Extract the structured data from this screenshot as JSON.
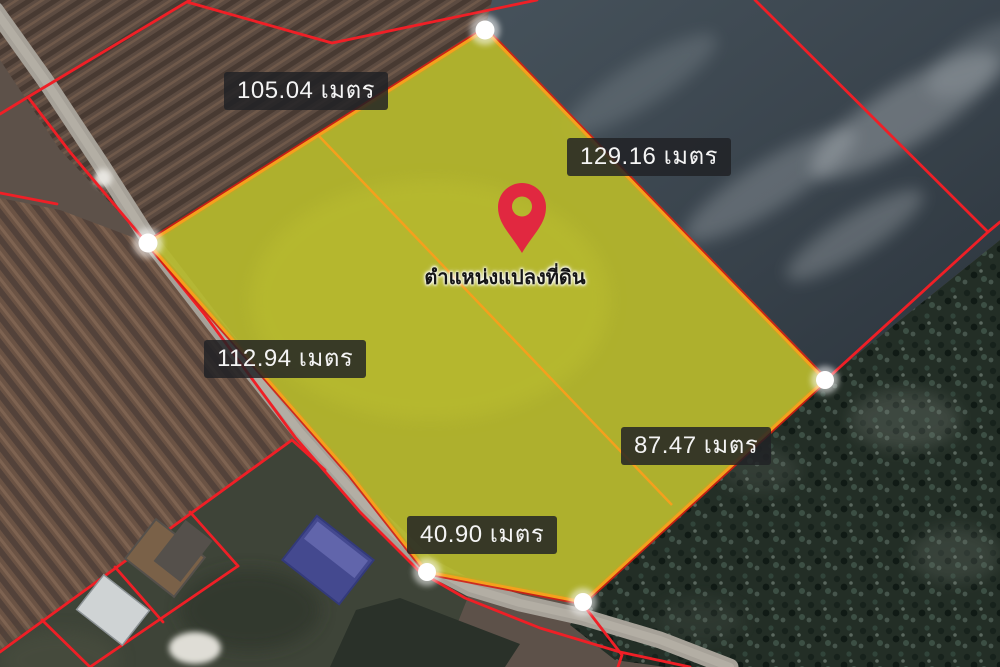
{
  "map": {
    "type": "satellite-parcel-view",
    "marker": {
      "icon": "location-pin-icon",
      "label": "ตำแหน่งแปลงที่ดิน",
      "color": "#e12840"
    },
    "unit": "เมตร",
    "measurements": [
      {
        "side": "north-west",
        "text": "105.04 เมตร",
        "value": 105.04,
        "unit": "เมตร"
      },
      {
        "side": "north-east",
        "text": "129.16 เมตร",
        "value": 129.16,
        "unit": "เมตร"
      },
      {
        "side": "west",
        "text": "112.94 เมตร",
        "value": 112.94,
        "unit": "เมตร"
      },
      {
        "side": "south-east",
        "text": "87.47 เมตร",
        "value": 87.47,
        "unit": "เมตร"
      },
      {
        "side": "south",
        "text": "40.90 เมตร",
        "value": 40.9,
        "unit": "เมตร"
      }
    ],
    "parcel": {
      "polygon_points": "485,30 148,243 350,474 427,572 583,602 825,380",
      "divider_points": "318,135 672,505",
      "fill_color": "#b5b82b",
      "highlight_border_color": "#f5a01d",
      "cadastral_line_color": "#ef1f26",
      "vertex_marker_color": "#ffffff",
      "vertex_count": 5
    }
  }
}
